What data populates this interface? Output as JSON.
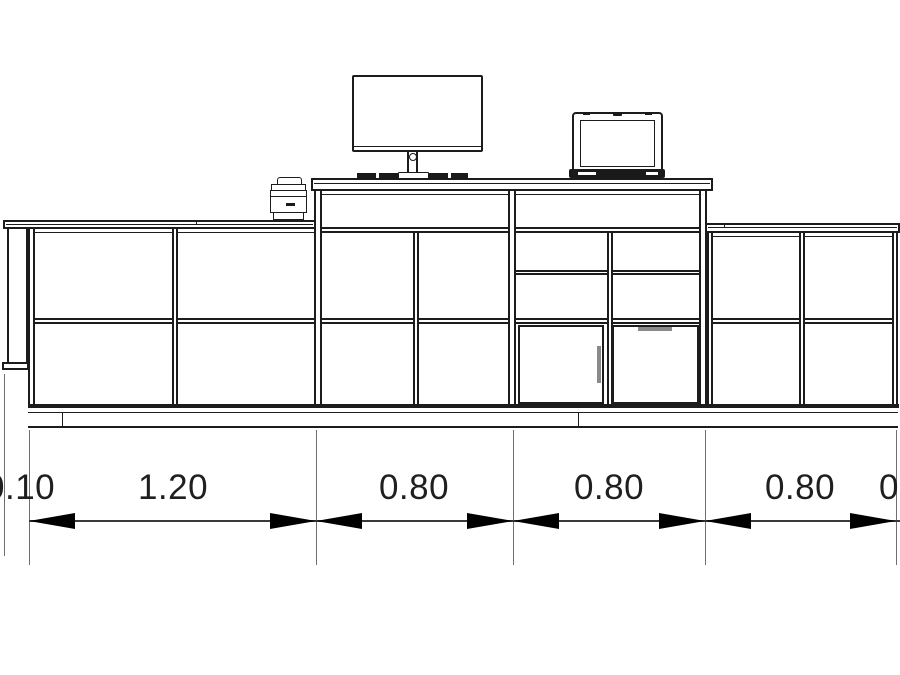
{
  "colors": {
    "background": "#ffffff",
    "line": "#1c1c1c",
    "dim_line": "#3a3a3a",
    "ext_line": "#6e6e6e",
    "text": "#1f1f1f",
    "handle": "#8a8a8a",
    "device_dark": "#1a1a1a"
  },
  "dimensions": {
    "labels": [
      "0.10",
      "1.20",
      "0.80",
      "0.80",
      "0.80",
      "0"
    ]
  },
  "equipment": {
    "monitor": "desktop-monitor",
    "keyboard": "keyboard",
    "laptop": "laptop",
    "printer": "printer"
  }
}
